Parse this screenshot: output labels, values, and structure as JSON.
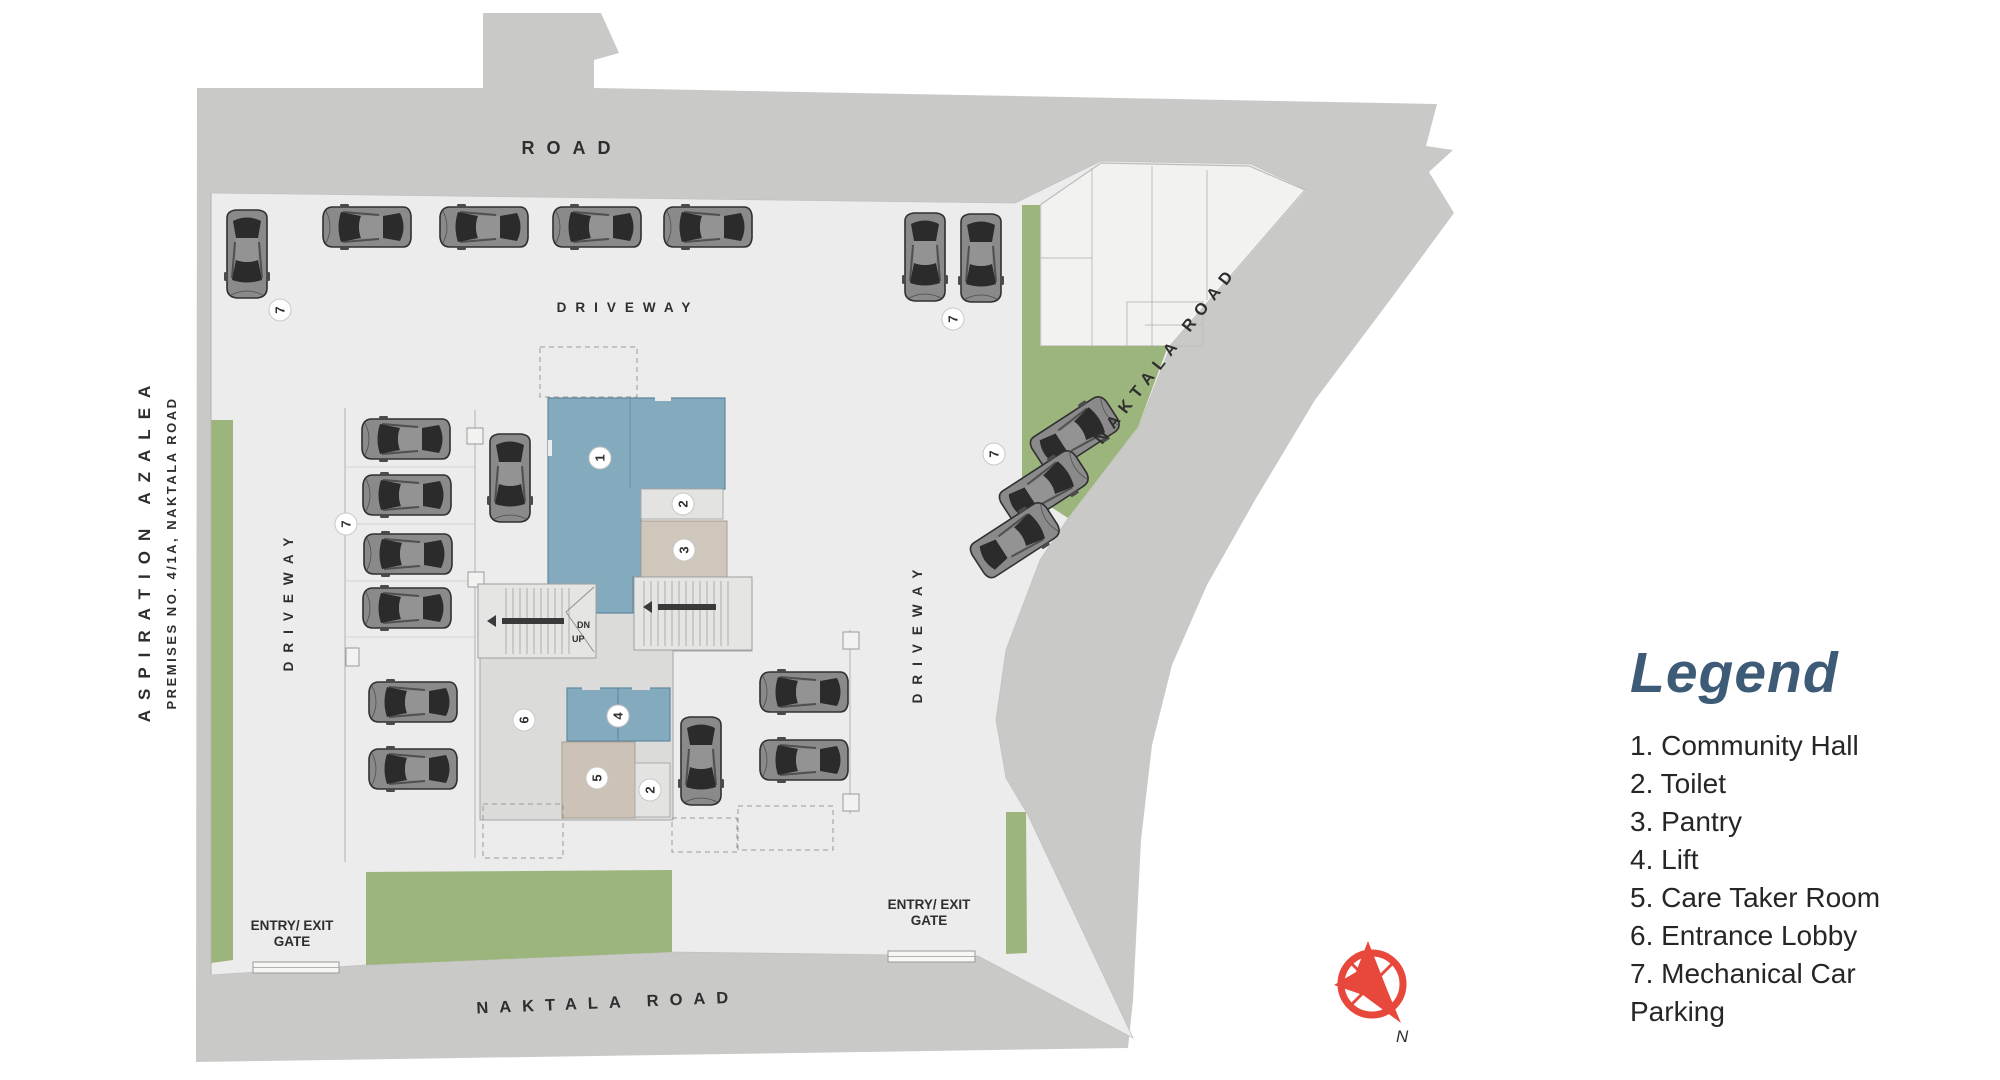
{
  "plan": {
    "road_top_label": "ROAD",
    "naktala_road_label": "NAKTALA ROAD",
    "driveway_label": "DRIVEWAY",
    "project_name": "ASPIRATION AZALEA",
    "premises_line": "PREMISES NO. 4/1A, NAKTALA ROAD",
    "gate_label_line1": "ENTRY/ EXIT",
    "gate_label_line2": "GATE",
    "stair_dn": "DN",
    "stair_up": "UP",
    "compass_north": "N",
    "colors": {
      "road": "#c9cac8",
      "site": "#ebeceb",
      "green": "#9bb57d",
      "hall_blue": "#84aabe",
      "room_tan": "#ccc2b8",
      "marker_number": "#24415e",
      "compass_red": "#e8473b",
      "legend_title": "#3d5b76"
    },
    "markers": [
      {
        "n": "1",
        "x": 600,
        "y": 458
      },
      {
        "n": "2",
        "x": 683,
        "y": 504
      },
      {
        "n": "3",
        "x": 684,
        "y": 550
      },
      {
        "n": "4",
        "x": 618,
        "y": 716
      },
      {
        "n": "5",
        "x": 597,
        "y": 778
      },
      {
        "n": "2",
        "x": 650,
        "y": 790
      },
      {
        "n": "6",
        "x": 524,
        "y": 720
      },
      {
        "n": "7",
        "x": 280,
        "y": 310
      },
      {
        "n": "7",
        "x": 346,
        "y": 524
      },
      {
        "n": "7",
        "x": 953,
        "y": 319
      },
      {
        "n": "7",
        "x": 994,
        "y": 454
      }
    ],
    "cars": [
      {
        "x": 367,
        "y": 227,
        "r": -90
      },
      {
        "x": 484,
        "y": 227,
        "r": -90
      },
      {
        "x": 597,
        "y": 227,
        "r": -90
      },
      {
        "x": 708,
        "y": 227,
        "r": -90
      },
      {
        "x": 247,
        "y": 254,
        "r": 180
      },
      {
        "x": 925,
        "y": 257,
        "r": 180
      },
      {
        "x": 981,
        "y": 258,
        "r": 180
      },
      {
        "x": 406,
        "y": 439,
        "r": -90
      },
      {
        "x": 407,
        "y": 495,
        "r": -90
      },
      {
        "x": 408,
        "y": 554,
        "r": -90
      },
      {
        "x": 407,
        "y": 608,
        "r": -90
      },
      {
        "x": 413,
        "y": 702,
        "r": -90
      },
      {
        "x": 413,
        "y": 769,
        "r": -90
      },
      {
        "x": 510,
        "y": 478,
        "r": 180
      },
      {
        "x": 804,
        "y": 692,
        "r": -90
      },
      {
        "x": 804,
        "y": 760,
        "r": -90
      },
      {
        "x": 701,
        "y": 761,
        "r": 180
      },
      {
        "x": 1075,
        "y": 434,
        "r": 57
      },
      {
        "x": 1044,
        "y": 488,
        "r": 57
      },
      {
        "x": 1015,
        "y": 540,
        "r": 57
      }
    ]
  },
  "legend": {
    "title": "Legend",
    "items": [
      "1. Community Hall",
      "2. Toilet",
      "3. Pantry",
      "4. Lift",
      "5. Care Taker Room",
      "6. Entrance Lobby",
      "7. Mechanical Car Parking"
    ]
  }
}
